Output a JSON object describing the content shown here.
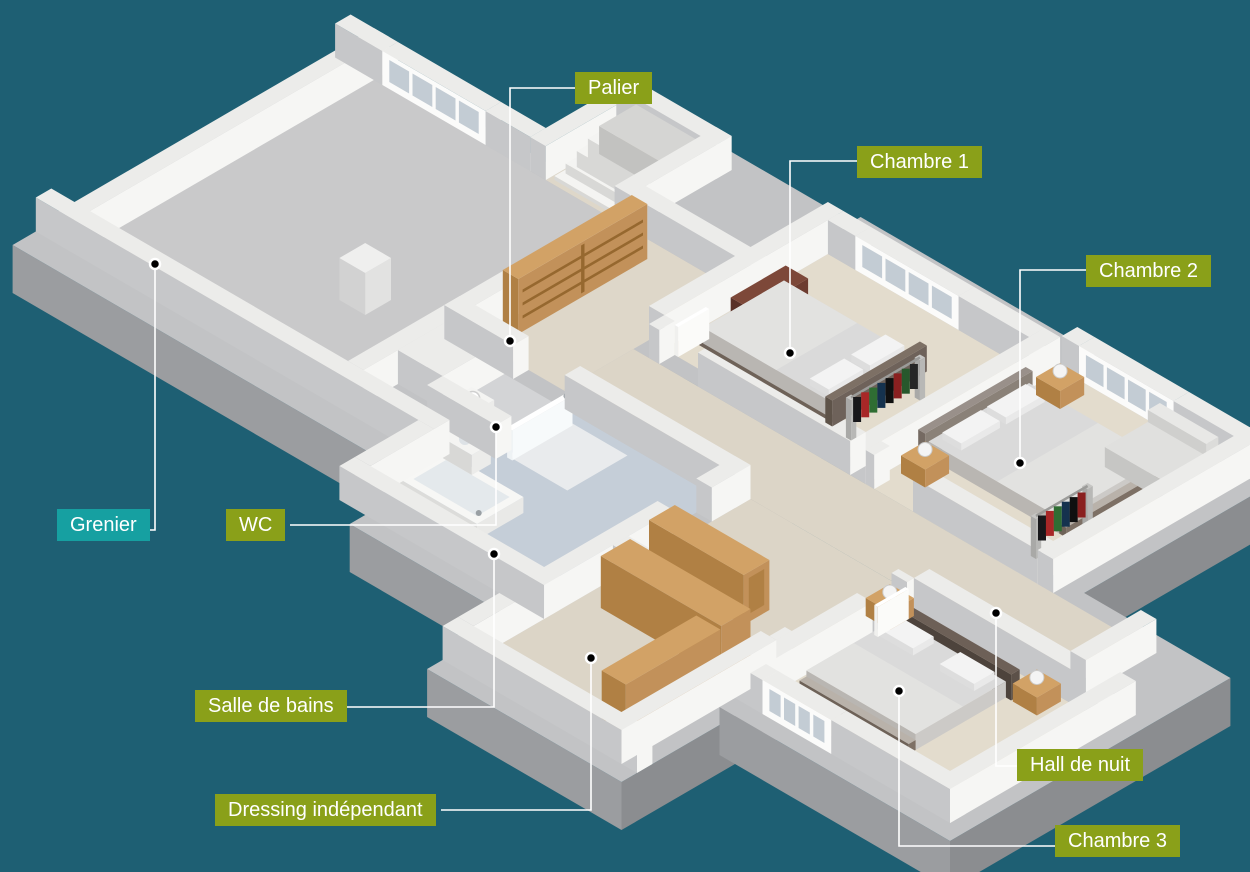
{
  "figure": {
    "type": "3d-floor-plan",
    "language": "fr",
    "floor": "étage avec 3 chambres, salle de bains, wc, dressing, grenier"
  },
  "colors": {
    "background": "#1e5f73",
    "label_green": "#8aa019",
    "label_teal": "#16a0a1",
    "leader_line": "#ffffff",
    "marker_dot": "#000000",
    "wall_white": "#f6f6f4",
    "wood": "#d2a266",
    "attic_floor": "#c9c9ca",
    "bedroom_floor": "#e3dccd",
    "bathroom_floor": "#c5ced8"
  },
  "callouts": [
    {
      "id": "palier",
      "label": "Palier",
      "style": "green"
    },
    {
      "id": "chambre-1",
      "label": "Chambre 1",
      "style": "green"
    },
    {
      "id": "chambre-2",
      "label": "Chambre 2",
      "style": "green"
    },
    {
      "id": "grenier",
      "label": "Grenier",
      "style": "teal"
    },
    {
      "id": "wc",
      "label": "WC",
      "style": "green"
    },
    {
      "id": "salle-de-bains",
      "label": "Salle de bains",
      "style": "green"
    },
    {
      "id": "dressing",
      "label": "Dressing indépendant",
      "style": "green"
    },
    {
      "id": "hall-de-nuit",
      "label": "Hall de nuit",
      "style": "green"
    },
    {
      "id": "chambre-3",
      "label": "Chambre 3",
      "style": "green"
    }
  ]
}
